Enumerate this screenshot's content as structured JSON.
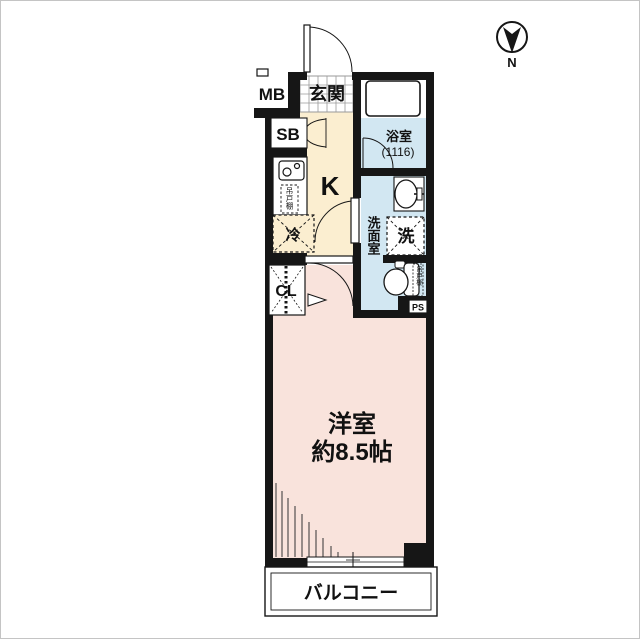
{
  "plan_title": "1K apartment floor plan",
  "compass": {
    "label": "N",
    "direction": "needle points down-page"
  },
  "rooms": {
    "genkan": {
      "label": "玄関"
    },
    "kitchen": {
      "label": "K"
    },
    "bathroom": {
      "label": "浴室",
      "size": "(1116)"
    },
    "washroom": {
      "label": "洗面室"
    },
    "western_room": {
      "label": "洋室",
      "size": "約8.5帖"
    },
    "balcony": {
      "label": "バルコニー"
    }
  },
  "fixtures": {
    "meter_box": "MB",
    "shoe_box": "SB",
    "refrigerator": "冷",
    "washing_machine": "洗",
    "closet": "CL",
    "pipe_space": "PS",
    "hanging_cupboard_kitchen": "吊戸棚",
    "hanging_cupboard_toilet": "吊戸棚"
  },
  "colors": {
    "wall": "#161616",
    "kitchen_floor": "#fbeed0",
    "wet_area_floor": "#d2e7f2",
    "room_floor": "#f9e3dc",
    "tile_line": "#9a9a9a",
    "frame": "#c4c4c4"
  }
}
